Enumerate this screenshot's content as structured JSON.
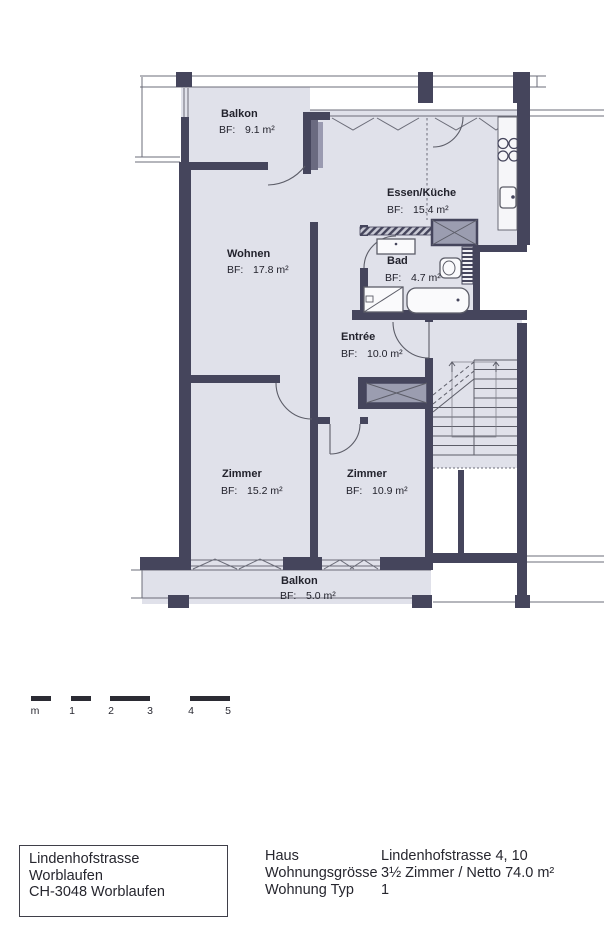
{
  "plan": {
    "rooms": [
      {
        "id": "balkon-top",
        "name": "Balkon",
        "area_label": "BF:",
        "area": "9.1 m²"
      },
      {
        "id": "essen-kueche",
        "name": "Essen/Küche",
        "area_label": "BF:",
        "area": "15.4 m²"
      },
      {
        "id": "wohnen",
        "name": "Wohnen",
        "area_label": "BF:",
        "area": "17.8 m²"
      },
      {
        "id": "bad",
        "name": "Bad",
        "area_label": "BF:",
        "area": "4.7 m²"
      },
      {
        "id": "entree",
        "name": "Entrée",
        "area_label": "BF:",
        "area": "10.0 m²"
      },
      {
        "id": "zimmer-1",
        "name": "Zimmer",
        "area_label": "BF:",
        "area": "15.2 m²"
      },
      {
        "id": "zimmer-2",
        "name": "Zimmer",
        "area_label": "BF:",
        "area": "10.9 m²"
      },
      {
        "id": "balkon-bottom",
        "name": "Balkon",
        "area_label": "BF:",
        "area": "5.0 m²"
      }
    ],
    "colors": {
      "wall": "#45455c",
      "room_fill": "#e0e1ea",
      "shaft_fill": "#9b9db0",
      "line": "#6b6c78"
    }
  },
  "scale_bar": {
    "labels": [
      "m",
      "1",
      "2",
      "3",
      "4",
      "5"
    ]
  },
  "footer": {
    "address_box": {
      "line1": "Lindenhofstrasse",
      "line2": "Worblaufen",
      "line3": "CH-3048 Worblaufen"
    },
    "details": [
      {
        "label": "Haus",
        "value": "Lindenhofstrasse 4, 10"
      },
      {
        "label": "Wohnungsgrösse",
        "value": "3½ Zimmer / Netto 74.0 m²"
      },
      {
        "label": "Wohnung Typ",
        "value": "1"
      }
    ]
  }
}
